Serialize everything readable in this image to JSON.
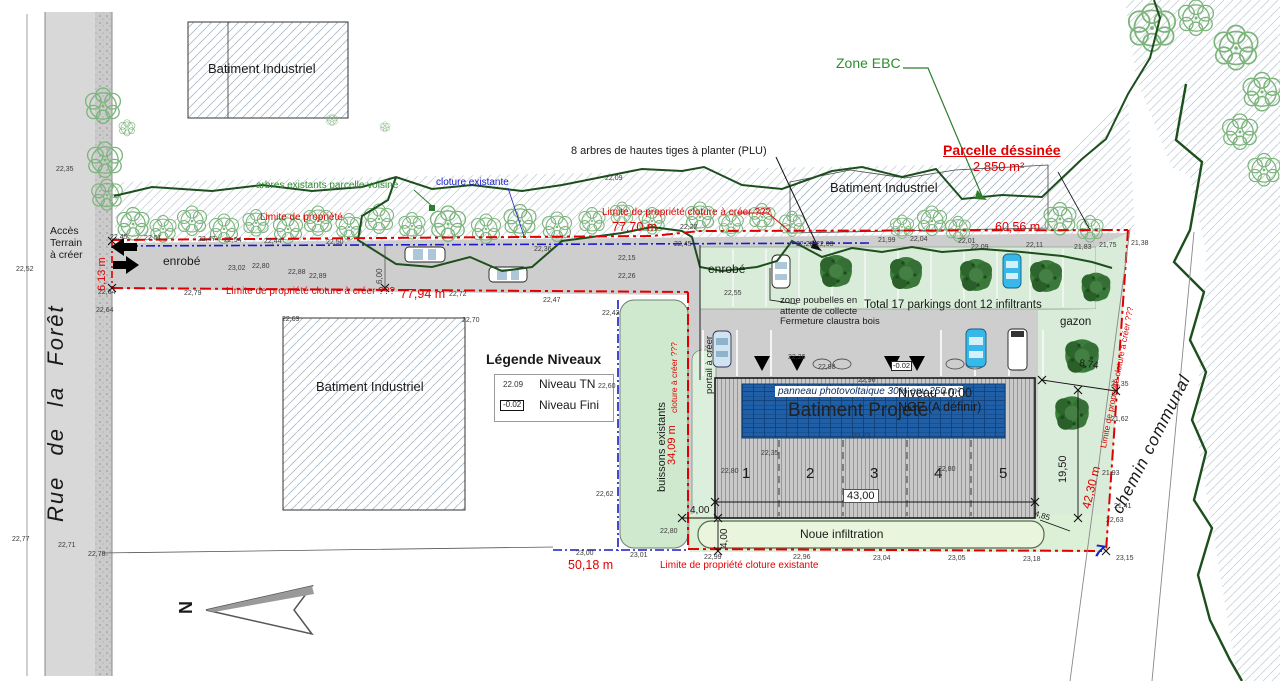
{
  "roads": {
    "left": "Rue de la Forêt",
    "right": "chemin communal"
  },
  "areas": {
    "enrobe": "enrobé",
    "gazon": "gazon",
    "noue": "Noue infiltration",
    "buissons": "buissons existants"
  },
  "buildings": {
    "industrial": "Batiment Industriel",
    "projected": {
      "title": "Batiment Projeté",
      "level": "Niveau +0.00\nNGF (A définir)",
      "pv": "panneau photovoltaique 30% env 250 m²",
      "bays": [
        "1",
        "2",
        "3",
        "4",
        "5"
      ]
    }
  },
  "legend": {
    "title": "Légende Niveaux",
    "tn_sample": "22.09",
    "tn_label": "Niveau TN",
    "fini_sample": "-0.02",
    "fini_label": "Niveau Fini"
  },
  "annotations": {
    "acces": "Accès\nTerrain\nà créer",
    "zone_ebc": "Zone EBC",
    "arbres_plu": "8 arbres de hautes tiges à planter (PLU)",
    "arbres_existants": "arbres existants parcelle voisine",
    "cloture_existante": "cloture existante",
    "limite_propriete": "Limite de propriété",
    "limite_cloture_creer": "Limite de propriété cloture à créer ???",
    "limite_existante": "Limite de propriété cloture existante",
    "cloture_creer_short": "cloture à créer ???",
    "parcelle": "Parcelle déssinée",
    "parcelle_area": "2 850 m²",
    "zone_poubelles": "zone poubelles en\nattente de collecte\nFermeture claustra bois",
    "total_parkings": "Total 17 parkings dont 12 infiltrants",
    "portail": "portail à créer",
    "north": "N",
    "borne": "7",
    "level_box": "-0.02"
  },
  "dimensions": {
    "top_west": "77,70 m",
    "south_west": "77,94 m",
    "top_east": "60,56 m",
    "bottom": "50,18 m",
    "east": "42,30 m",
    "west_inner": "34,09 m",
    "acces_width": "6,13 m",
    "drive_width": "6,00",
    "bld_width": "43,00",
    "bld_depth": "19,50",
    "gap_ne": "8,74",
    "gap_w": "4,00",
    "gap_s": "4,00",
    "gap_se": "4,85"
  },
  "colors": {
    "boundary_red": "#e10000",
    "boundary_blue": "#1a1acc",
    "vegetation_green": "#1c4f1c",
    "pv_blue": "#1f5fa8",
    "parcel_gray": "#cecece",
    "green_light": "#d9ecd9"
  },
  "elevations": [
    "22,35",
    "22,52",
    "22,77",
    "22,64",
    "22,64",
    "22,71",
    "22,78",
    "23,02",
    "22,80",
    "22,88",
    "22,89",
    "22,79",
    "22,72",
    "22,47",
    "22,70",
    "22,69",
    "22,42",
    "22,60",
    "22,62",
    "22,36",
    "22,15",
    "22,26",
    "22,55",
    "22,22",
    "22,09",
    "22,28",
    "22,03",
    "21,99",
    "22,04",
    "22,01",
    "22,09",
    "22,11",
    "21,83",
    "21,75",
    "21,38",
    "22,96",
    "22,26",
    "22,98",
    "22,73",
    "22,35",
    "22,80",
    "22,80",
    "23,00",
    "23,01",
    "22,99",
    "22,96",
    "23,04",
    "23,05",
    "23,18",
    "23,15",
    "22,80",
    "21,35",
    "21,62",
    "21,93",
    "21,41",
    "22,63",
    "22,45",
    "22,51",
    "22,47",
    "22,54",
    "22,44",
    "22,50",
    "22,45"
  ]
}
